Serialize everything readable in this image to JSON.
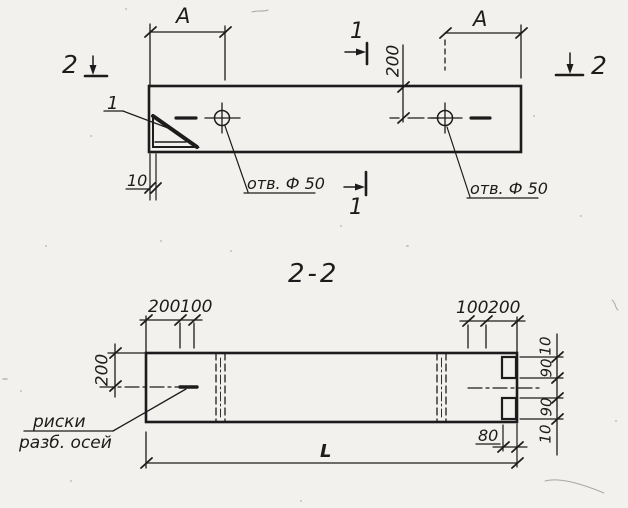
{
  "drawing": {
    "section_title": "2-2",
    "top_view": {
      "dim_a_left": "A",
      "dim_a_right": "A",
      "dim_200_vertical": "200",
      "dim_10": "10",
      "hole_left_label": "отв. Ф 50",
      "hole_right_label": "отв. Ф 50",
      "corner_detail_callout": "1",
      "section_marker_1_top": "1",
      "section_marker_1_bottom": "1",
      "section_marker_2_left": "2",
      "section_marker_2_right": "2"
    },
    "section_view": {
      "dim_200_top_left": "200",
      "dim_100_top_left": "100",
      "dim_100_top_right": "100",
      "dim_200_top_right": "200",
      "dim_200_side": "200",
      "dim_chain_10_top": "10",
      "dim_chain_90_top": "90",
      "dim_chain_90_bottom": "90",
      "dim_chain_10_bottom": "10",
      "dim_80": "80",
      "dim_length": "L",
      "axis_marks_label_line1": "риски",
      "axis_marks_label_line2": "разб. осей"
    },
    "colors": {
      "ink": "#1c1c1c",
      "paper": "#f2f1ed"
    }
  }
}
